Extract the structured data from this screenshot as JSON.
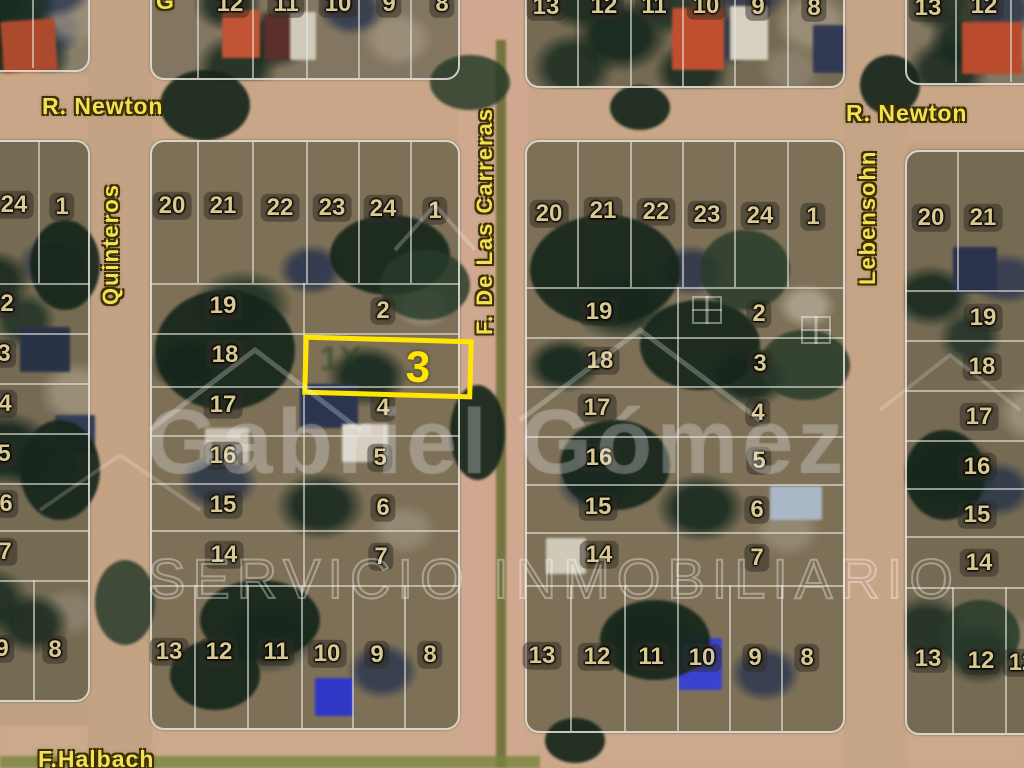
{
  "map": {
    "streets": {
      "newton": "R. Newton",
      "quinteros": "Quinteros",
      "carreras": "F. De Las Carreras",
      "lebensohn": "Lebensohn",
      "halbach": "F.Halbach",
      "partial_top_label": "G"
    },
    "highlight": {
      "lot": "3",
      "color": "#ffe600"
    },
    "watermark": {
      "name": "Gabriel Gómez",
      "tagline": "SERVICIO INMOBILIARIO",
      "partial_mark": "1X"
    },
    "lots": [
      {
        "label": "12",
        "x": 230,
        "y": 4
      },
      {
        "label": "11",
        "x": 286,
        "y": 4
      },
      {
        "label": "10",
        "x": 338,
        "y": 4
      },
      {
        "label": "9",
        "x": 389,
        "y": 4
      },
      {
        "label": "8",
        "x": 442,
        "y": 4
      },
      {
        "label": "13",
        "x": 546,
        "y": 7
      },
      {
        "label": "12",
        "x": 604,
        "y": 6
      },
      {
        "label": "11",
        "x": 654,
        "y": 6
      },
      {
        "label": "10",
        "x": 706,
        "y": 6
      },
      {
        "label": "9",
        "x": 758,
        "y": 7
      },
      {
        "label": "8",
        "x": 814,
        "y": 8
      },
      {
        "label": "13",
        "x": 928,
        "y": 8
      },
      {
        "label": "12",
        "x": 984,
        "y": 6
      },
      {
        "label": "24",
        "x": 14,
        "y": 205
      },
      {
        "label": "1",
        "x": 62,
        "y": 207
      },
      {
        "label": "2",
        "x": 7,
        "y": 304
      },
      {
        "label": "3",
        "x": 4,
        "y": 354
      },
      {
        "label": "4",
        "x": 5,
        "y": 404
      },
      {
        "label": "5",
        "x": 4,
        "y": 454
      },
      {
        "label": "6",
        "x": 6,
        "y": 504
      },
      {
        "label": "7",
        "x": 5,
        "y": 552
      },
      {
        "label": "9",
        "x": 2,
        "y": 649
      },
      {
        "label": "8",
        "x": 55,
        "y": 650
      },
      {
        "label": "20",
        "x": 172,
        "y": 206
      },
      {
        "label": "21",
        "x": 223,
        "y": 206
      },
      {
        "label": "22",
        "x": 280,
        "y": 208
      },
      {
        "label": "23",
        "x": 332,
        "y": 208
      },
      {
        "label": "24",
        "x": 383,
        "y": 209
      },
      {
        "label": "1",
        "x": 435,
        "y": 211
      },
      {
        "label": "19",
        "x": 223,
        "y": 306
      },
      {
        "label": "2",
        "x": 383,
        "y": 311
      },
      {
        "label": "18",
        "x": 225,
        "y": 355
      },
      {
        "label": "17",
        "x": 223,
        "y": 405
      },
      {
        "label": "4",
        "x": 383,
        "y": 408
      },
      {
        "label": "16",
        "x": 223,
        "y": 456
      },
      {
        "label": "5",
        "x": 380,
        "y": 458
      },
      {
        "label": "15",
        "x": 223,
        "y": 505
      },
      {
        "label": "6",
        "x": 383,
        "y": 508
      },
      {
        "label": "14",
        "x": 224,
        "y": 555
      },
      {
        "label": "7",
        "x": 381,
        "y": 557
      },
      {
        "label": "13",
        "x": 169,
        "y": 652
      },
      {
        "label": "12",
        "x": 219,
        "y": 652
      },
      {
        "label": "11",
        "x": 276,
        "y": 652
      },
      {
        "label": "10",
        "x": 327,
        "y": 654
      },
      {
        "label": "9",
        "x": 377,
        "y": 655
      },
      {
        "label": "8",
        "x": 430,
        "y": 655
      },
      {
        "label": "20",
        "x": 549,
        "y": 214
      },
      {
        "label": "21",
        "x": 603,
        "y": 211
      },
      {
        "label": "22",
        "x": 656,
        "y": 212
      },
      {
        "label": "23",
        "x": 707,
        "y": 215
      },
      {
        "label": "24",
        "x": 760,
        "y": 216
      },
      {
        "label": "1",
        "x": 813,
        "y": 217
      },
      {
        "label": "19",
        "x": 599,
        "y": 312
      },
      {
        "label": "2",
        "x": 759,
        "y": 314
      },
      {
        "label": "18",
        "x": 600,
        "y": 361
      },
      {
        "label": "3",
        "x": 760,
        "y": 364
      },
      {
        "label": "17",
        "x": 597,
        "y": 408
      },
      {
        "label": "4",
        "x": 758,
        "y": 413
      },
      {
        "label": "16",
        "x": 599,
        "y": 458
      },
      {
        "label": "5",
        "x": 759,
        "y": 461
      },
      {
        "label": "15",
        "x": 598,
        "y": 507
      },
      {
        "label": "6",
        "x": 757,
        "y": 510
      },
      {
        "label": "14",
        "x": 599,
        "y": 555
      },
      {
        "label": "7",
        "x": 757,
        "y": 558
      },
      {
        "label": "13",
        "x": 542,
        "y": 656
      },
      {
        "label": "12",
        "x": 597,
        "y": 657
      },
      {
        "label": "11",
        "x": 651,
        "y": 657
      },
      {
        "label": "10",
        "x": 702,
        "y": 658
      },
      {
        "label": "9",
        "x": 755,
        "y": 658
      },
      {
        "label": "8",
        "x": 807,
        "y": 658
      },
      {
        "label": "20",
        "x": 931,
        "y": 218
      },
      {
        "label": "21",
        "x": 983,
        "y": 218
      },
      {
        "label": "19",
        "x": 983,
        "y": 318
      },
      {
        "label": "18",
        "x": 982,
        "y": 367
      },
      {
        "label": "17",
        "x": 979,
        "y": 417
      },
      {
        "label": "16",
        "x": 977,
        "y": 467
      },
      {
        "label": "15",
        "x": 977,
        "y": 515
      },
      {
        "label": "14",
        "x": 979,
        "y": 563
      },
      {
        "label": "13",
        "x": 928,
        "y": 659
      },
      {
        "label": "12",
        "x": 981,
        "y": 661
      },
      {
        "label": "12",
        "x": 1022,
        "y": 663
      }
    ]
  }
}
